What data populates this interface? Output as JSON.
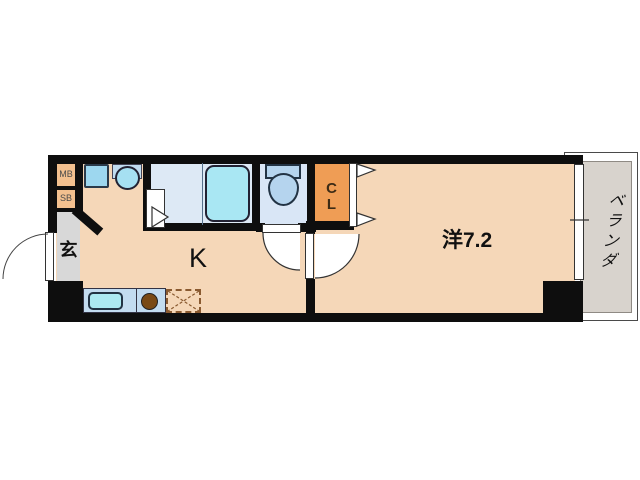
{
  "labels": {
    "kitchen": "K",
    "western_room": "洋7.2",
    "entrance": "玄",
    "veranda": "ベランダ",
    "meter_box": "MB",
    "shoe_box": "SB",
    "closet_line1": "C",
    "closet_line2": "L"
  },
  "fixtures": [
    "washing-machine-pan",
    "washbasin",
    "bathtub",
    "toilet",
    "kitchen-sink",
    "gas-burner",
    "refrigerator-space",
    "entrance-door",
    "bathroom-folding-door",
    "toilet-door",
    "room-door",
    "closet-folding-door",
    "sliding-window"
  ],
  "colors": {
    "wall": "#0e0e0e",
    "floor_peach": "#f5d7b8",
    "closet_orange": "#ef9d55",
    "box_orange": "#f3c08f",
    "wet_floor_blue": "#dde9f5",
    "fixture_cyan": "#a9e7f3",
    "counter_blue": "#c3dcf0",
    "entrance_gray": "#d8d8d8",
    "veranda_gray": "#d8d3cd",
    "burner_brown": "#7a4a15"
  }
}
